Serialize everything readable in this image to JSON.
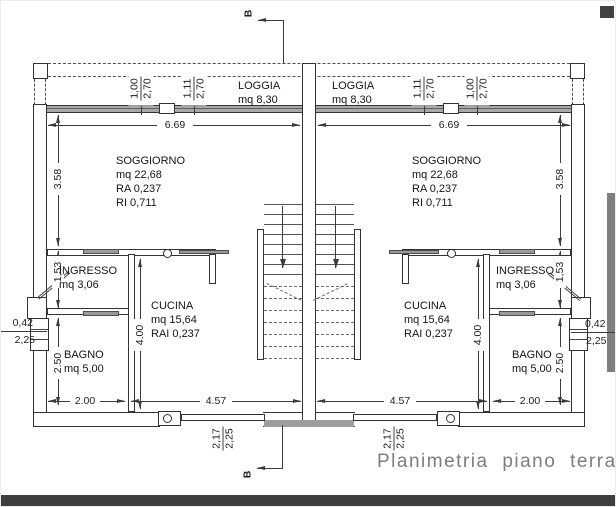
{
  "title": "Planimetria piano terra",
  "section_label": "B",
  "colors": {
    "line": "#3c3c3c",
    "glass_band": "#a9a9a9",
    "footer_bar": "#3f3f3f",
    "side_bar": "#7f7f7f",
    "title_text": "#7d7d7d"
  },
  "rooms": {
    "loggia": {
      "name": "LOGGIA",
      "area": "mq 8,30"
    },
    "soggiorno": {
      "name": "SOGGIORNO",
      "area": "mq 22,68",
      "ra": "RA 0,237",
      "ri": "RI 0,711"
    },
    "ingresso": {
      "name": "INGRESSO",
      "area": "mq 3,06"
    },
    "cucina": {
      "name": "CUCINA",
      "area": "mq 15,64",
      "rai": "RAI 0,237"
    },
    "bagno": {
      "name": "BAGNO",
      "area": "mq 5,00"
    }
  },
  "dimensions": {
    "loggia_width": "6.69",
    "soggiorno_depth": "3.58",
    "window_a_width": "1,00",
    "window_a_height": "2,70",
    "window_b_width": "1,11",
    "window_b_height": "2,70",
    "ingresso_depth": "1,53",
    "bagno_depth": "2.50",
    "bagno_width": "2.00",
    "cucina_width": "4.57",
    "cucina_depth": "4.00",
    "side_window_width": "0,42",
    "side_window_height": "2,25",
    "entry_width": "2,17",
    "entry_height": "2,25"
  }
}
